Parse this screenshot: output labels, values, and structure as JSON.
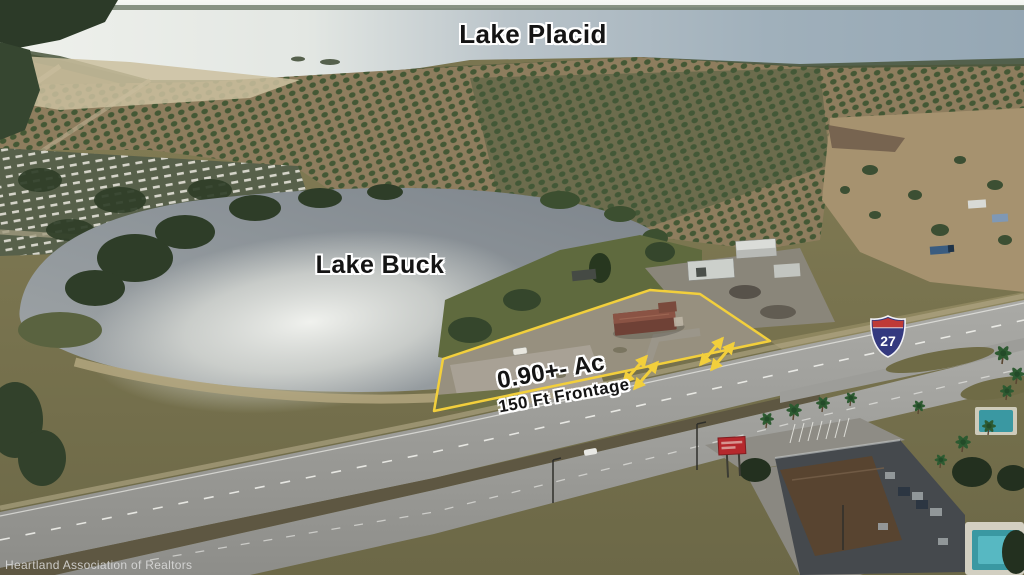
{
  "labels": {
    "lake_placid": "Lake Placid",
    "lake_buck": "Lake Buck",
    "acreage": "0.90+- Ac",
    "frontage": "150 Ft Frontage"
  },
  "highway_shield": {
    "route": "27"
  },
  "watermark": "Heartland Association of Realtors",
  "colors": {
    "parcel_outline": "#f2cf3c",
    "arrow": "#f2cf3c",
    "shield_blue": "#34397f",
    "shield_red": "#bf3a36",
    "pool_teal": "#3a98a2",
    "sign_red": "#b5282c"
  }
}
